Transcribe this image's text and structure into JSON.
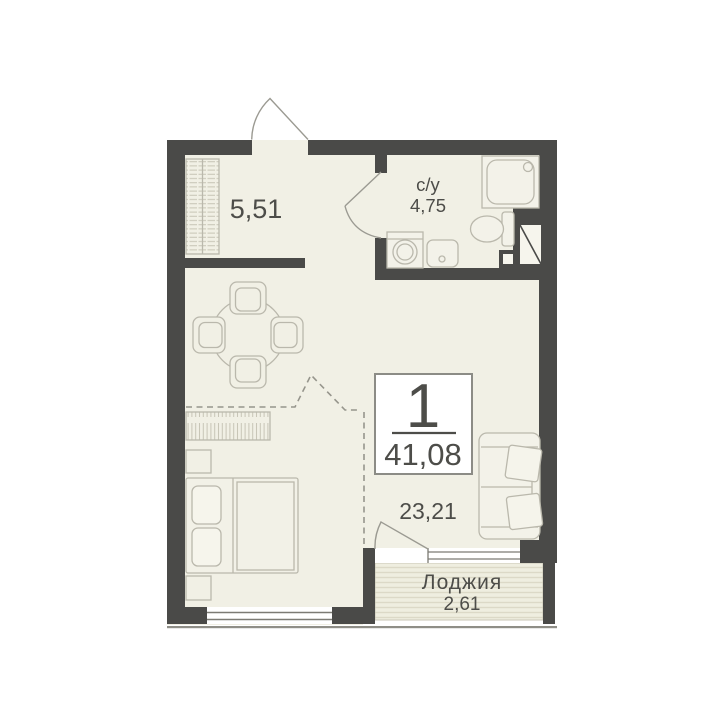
{
  "badge": {
    "rooms_count": "1",
    "total_area": "41,08"
  },
  "rooms": {
    "hallway": {
      "area": "5,51"
    },
    "bathroom": {
      "label": "с/у",
      "area": "4,75"
    },
    "living": {
      "area": "23,21"
    },
    "loggia": {
      "label": "Лоджия",
      "area": "2,61"
    }
  },
  "colors": {
    "wall": "#4a4a48",
    "floor": "#f1f0e5",
    "furniture_outline": "#bab8ac",
    "text": "#4d4d49",
    "badge_border": "#8c8c86",
    "background": "#ffffff"
  }
}
